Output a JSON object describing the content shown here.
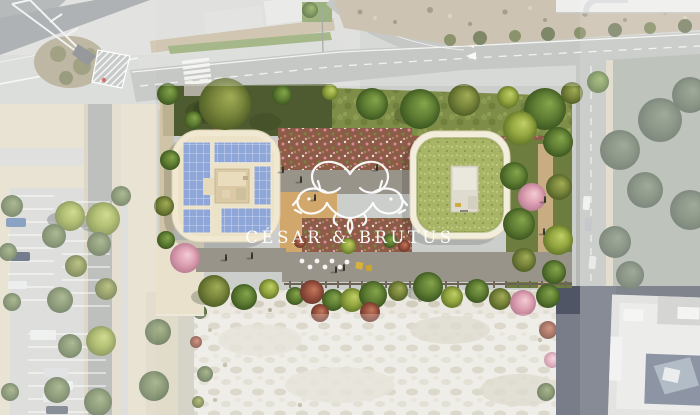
{
  "watermark": {
    "brand": "CÉSAR & BRUTUS",
    "emblem": "two-dog-heads-crest-icon"
  },
  "colors": {
    "watermark": "#ffffff",
    "building_trim": "#f1e8d1",
    "solar_panel": "#8ea6d8",
    "green_roof": "#a9b566",
    "lawn_dark": "#4e5b30",
    "lawn_light": "#7e8d48",
    "meadow": "#8d5c49",
    "deck_tan": "#d2a76c",
    "path_gray": "#99948a",
    "path_sand": "#c9ad82",
    "asphalt_dark": "#454b58",
    "road_gray": "#b4b7b4",
    "plaza_gray": "#d7d8d5",
    "parking_sand": "#e1d9c3",
    "gravel_white": "#eae8e0",
    "rock_slope": "#bdb09a"
  }
}
